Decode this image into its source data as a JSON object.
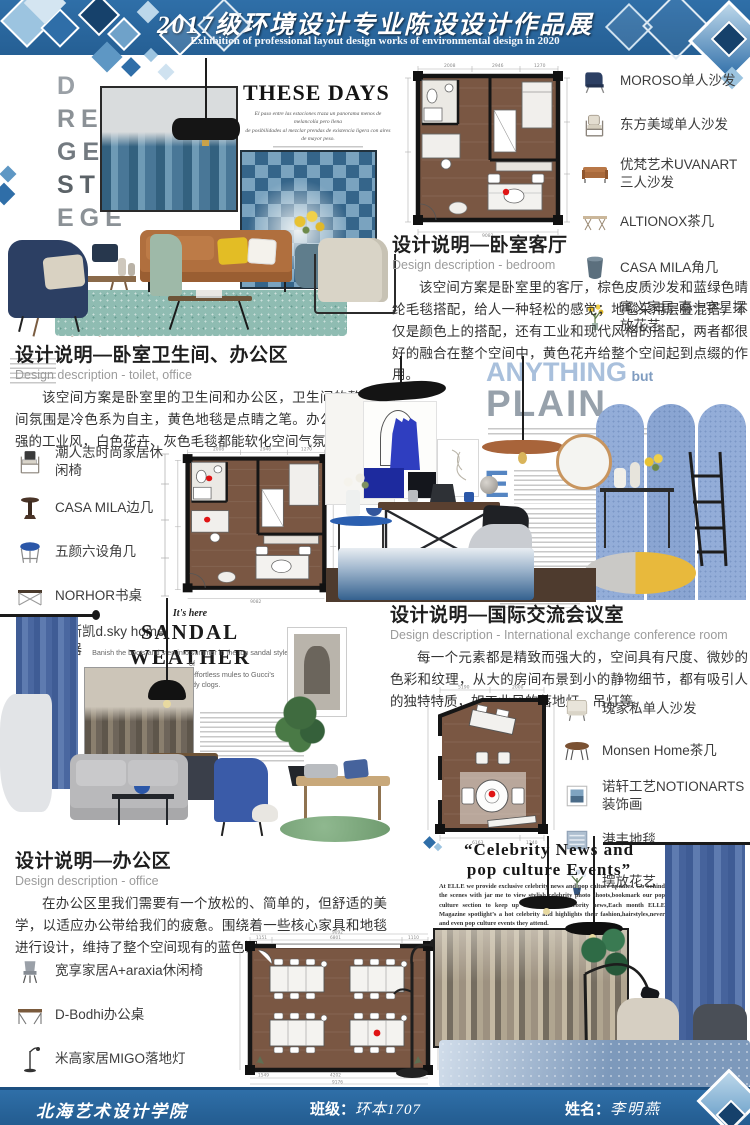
{
  "header": {
    "title": "2017级环境设计专业陈设设计作品展",
    "subtitle": "Exhibition of professional layout design works of environmental design in 2020"
  },
  "footer": {
    "school": "北海艺术设计学院",
    "class_label": "班级：",
    "class_value": "环本1707",
    "name_label": "姓名：",
    "name_value": "李明燕"
  },
  "these_days": {
    "vertical_letters": {
      "l0": "D",
      "l1": "REN",
      "l2": "GE",
      "l3": "STR",
      "l4": "EGE",
      "l5": "R"
    },
    "title": "THESE DAYS",
    "deck_line1": "El paso entre las estaciones traza un panorama menos de melancolía pero llena",
    "deck_line2": "de posibilidades al mezclar prendas de existencia ligera con aires de mayor peso."
  },
  "anything_but_plain": {
    "word1": "ANYTHING",
    "word2": "but",
    "word3": "PLAIN",
    "dropcap": "E"
  },
  "sandal_weather": {
    "kicker": "It's here",
    "title": "SANDAL WEATHER",
    "deck_line1": "Banish the boots and step into summer in the top sandal styles of",
    "deck_line2": "the season, from Chloé's effortless mules to Gucci's streetready clogs."
  },
  "celebrity": {
    "title_line1": "“Celebrity News and",
    "title_line2": "pop culture Events”",
    "body": "At ELLE we provide exclusive celebrity news and pop culture updates. Go behind the scenes with jar me to view stylish celebrity photo shoots,bookmark our pop culture section to keep up on the latest celebrity news,Each month ELLE Magazine spotlight’s a hot celebrity and highlights their fashion,hairstyles,never and even pop culture events they attend."
  },
  "sections": {
    "bedroom": {
      "title": "设计说明—卧室客厅",
      "subtitle": "Design description - bedroom",
      "body": "该空间方案是卧室里的客厅，棕色皮质沙发和蓝绿色晴纶毛毯搭配，给人一种轻松的感觉；地毯采用层叠混搭，不仅是颜色上的搭配，还有工业和现代风格的搭配，两者都很好的融合在整个空间中，黄色花卉给整个空间起到点缀的作用。"
    },
    "toilet_office": {
      "title": "设计说明—卧室卫生间、办公区",
      "subtitle": "Design description - toilet, office",
      "body": "该空间方案是卧室里的卫生间和办公区，卫生间的整个空间氛围是冷色系为自主，黄色地毯是点睛之笔。办公区域有很强的工业风，白色花卉、灰色毛毯都能软化空间气氛。"
    },
    "conference": {
      "title": "设计说明—国际交流会议室",
      "subtitle": "Design description - International exchange conference room",
      "body": "每一个元素都是精致而强大的，空间具有尺度、微妙的色彩和纹理，从大的房间布景到小的静物细节，都有吸引人的独特特质，如工业风的落地灯、吊灯等。"
    },
    "office": {
      "title": "设计说明—办公区",
      "subtitle": "Design description - office",
      "body": "在办公区里我们需要有一个放松的、简单的，但舒适的美学，以适应办公带给我们的疲惫。围绕着一些核心家具和地毯进行设计，维持了整个空间现有的蓝色调。"
    }
  },
  "furniture": {
    "bedroom": [
      {
        "icon": "wingback-armchair-icon",
        "label": "MOROSO单人沙发"
      },
      {
        "icon": "wood-armchair-icon",
        "label": "东方美域单人沙发"
      },
      {
        "icon": "leather-sofa-icon",
        "label": "优梵艺术UVANART三人沙发"
      },
      {
        "icon": "coffee-table-icon",
        "label": "ALTIONOX茶几"
      },
      {
        "icon": "drum-side-table-icon",
        "label": "CASA MILA角几"
      },
      {
        "icon": "flower-arrangement-icon",
        "label": "寓义家居-南十字星摆放花艺"
      }
    ],
    "toilet_office": [
      {
        "icon": "lounge-chair-icon",
        "label": "潮人志时尚家居休闲椅"
      },
      {
        "icon": "pedestal-table-icon",
        "label": "CASA MILA边几"
      },
      {
        "icon": "blue-stool-icon",
        "label": "五颜六设角几"
      },
      {
        "icon": "writing-desk-icon",
        "label": "NORHOR书桌"
      },
      {
        "icon": "bowl-vase-icon",
        "label": "迪斯凯d.sky home花器"
      }
    ],
    "conference": [
      {
        "icon": "fabric-armchair-icon",
        "label": "瑰家私单人沙发"
      },
      {
        "icon": "round-table-icon",
        "label": "Monsen Home茶几"
      },
      {
        "icon": "framed-art-icon",
        "label": "诺轩工艺NOTIONARTS装饰画"
      },
      {
        "icon": "rug-icon",
        "label": "港丰地毯"
      },
      {
        "icon": "vase-flowers-icon",
        "label": "摆放花艺"
      }
    ],
    "office": [
      {
        "icon": "gray-chair-icon",
        "label": "宽享家居A+araxia休闲椅"
      },
      {
        "icon": "office-desk-icon",
        "label": "D-Bodhi办公桌"
      },
      {
        "icon": "floor-lamp-icon",
        "label": "米高家居MIGO落地灯"
      },
      {
        "icon": "bedding-icon",
        "label": "寐MINE床品"
      }
    ]
  },
  "floor_plans": {
    "plan1": {
      "dim_top1": "2008",
      "dim_top2": "2946",
      "dim_top3": "1270",
      "dim_bottom": "9082"
    },
    "plan2": {
      "dim_top1": "2008",
      "dim_top2": "2946",
      "dim_top3": "1270",
      "dim_bottom": "9082"
    },
    "conference": {
      "dim_top1": "5190",
      "dim_top2": "2000",
      "dim_bottom1": "6163",
      "dim_bottom2": "1240",
      "dim_total": "6460"
    },
    "office": {
      "dim_top1": "1151",
      "dim_top2": "6801",
      "dim_top3": "1110",
      "dim_top_total": "9092",
      "dim_bottom1": "1549",
      "dim_bottom2": "4202",
      "dim_bottom3": "1423",
      "dim_bottom_total": "9176"
    }
  },
  "colors": {
    "banner_blue": "#2f6fa8",
    "wood_brown": "#7a5743",
    "teal_rug": "#8fbcb2",
    "leather": "#b06f3e",
    "navy": "#2c3f63",
    "accent_yellow": "#e3bd25",
    "screen_blue": "#93add8",
    "curtain_blue": "#46639c",
    "marker_red": "#e01414"
  }
}
